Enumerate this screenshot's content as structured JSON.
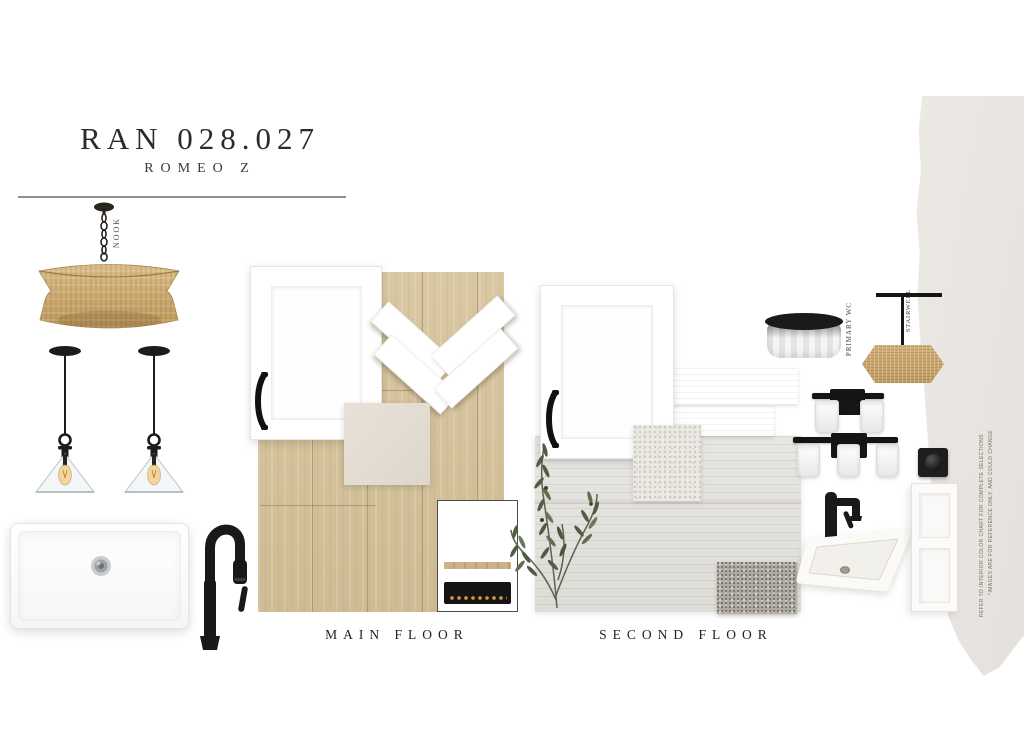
{
  "header": {
    "title": "RAN 028.027",
    "subtitle": "ROMEO Z"
  },
  "labels": {
    "nook": "NOOK",
    "primary": "PRIMARY WC",
    "stairwell": "STAIRWELL",
    "main_floor": "MAIN FLOOR",
    "second_floor": "SECOND FLOOR"
  },
  "disclaimer": {
    "line1": "*IMAGES ARE FOR REFERENCE ONLY, AND COULD CHANGE",
    "line2": "REFER TO INTERIOR COLOR CHART FOR COMPLETE SELECTIONS"
  },
  "colors": {
    "oak_floor": "#d5c39c",
    "rattan": "#c9a76d",
    "paint_swatch": "#e9e6e2",
    "cream_tile": "#e2dcd2",
    "pale_tile": "#e3e2dd",
    "pebble_tile": "#aeaaa1",
    "matte_black": "#1b1b1b"
  }
}
